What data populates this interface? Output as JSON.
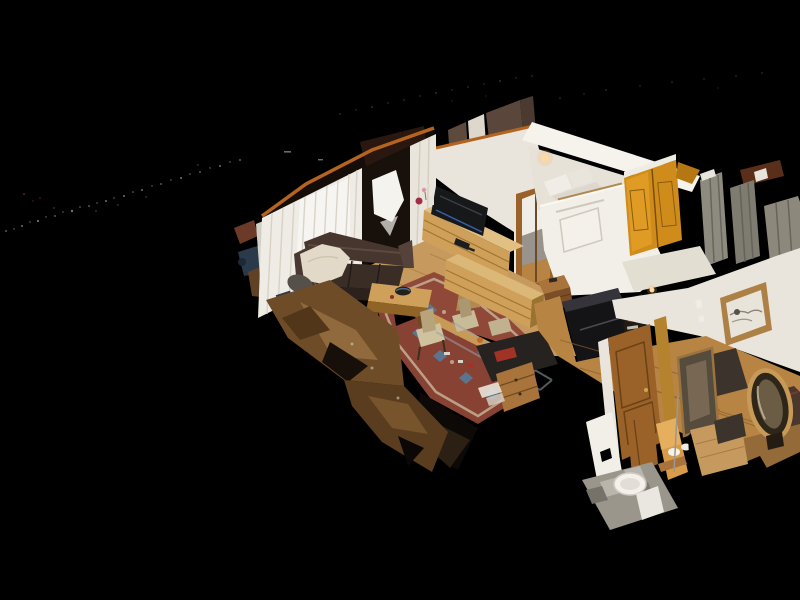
{
  "app": {
    "name": "3D tour viewer",
    "view_mode": "dollhouse",
    "chrome": "none — full-bleed 3D viewport on black"
  },
  "scene": {
    "description": "Cut-away dollhouse view of a chalet apartment photogrammetry scan, seen from an elevated three-quarter angle on a black void with point-cloud noise speckles and torn scan geometry at the edges.",
    "rooms": [
      {
        "name": "living-room",
        "objects": [
          "dark-brown-sofa",
          "sheepskin-throw",
          "oak-coffee-table",
          "decorative-bowl",
          "oriental-rug",
          "flat-screen-tv",
          "oak-sideboard",
          "dining-chairs",
          "glass-dining-table",
          "cardboard-box",
          "dark-desk",
          "red-folder",
          "oak-drawer-cabinet",
          "sheer-white-curtains",
          "balcony-door-gap",
          "roof-beam"
        ]
      },
      {
        "name": "bedroom",
        "objects": [
          "bed-with-white-pillows",
          "grey-blanket",
          "wall-sconces",
          "golden-wardrobe",
          "brown-window-curtains",
          "mirrored-doorway",
          "white-radiator-panel"
        ]
      },
      {
        "name": "hallway",
        "objects": [
          "framed-sketch-picture",
          "dark-fireplace",
          "open-wooden-door",
          "tall-wall-mirror",
          "oval-wood-mirror",
          "dark-doormats",
          "oak-plank-floor",
          "staircase-steps",
          "small-wood-chest"
        ]
      },
      {
        "name": "bathroom-wc",
        "objects": [
          "white-toilet",
          "washbasin",
          "glowing-vanity-wall",
          "grey-tiled-floor",
          "wood-panel-door",
          "glass-shower-panels"
        ]
      }
    ],
    "artifacts": [
      "point-cloud-noise-streaks",
      "broken-scan-geometry-trail",
      "overexposed-window-blob"
    ]
  },
  "palette": {
    "background": "#000000",
    "speckle": "#9fb2b8",
    "speckle_red": "#7a2a1a",
    "beam_orange": "#b4641f",
    "roof_dark": "#150d07",
    "roof_chunk": "#2a1810",
    "wall_white": "#e9e5dd",
    "wall_bright": "#f2efe8",
    "ceiling_white": "#f6f3ec",
    "curtain_white": "#efece6",
    "curtain_shadow": "#d4cdc0",
    "curtain_brown": "#5d4a3c",
    "gap_dark": "#17100b",
    "blob_white": "#f5f3ee",
    "sofa_brown": "#46362d",
    "sofa_seat": "#3a2d26",
    "sofa_front": "#2c211c",
    "sofa_arm": "#4a3930",
    "fur_cream": "#e3d9c8",
    "bean_grey": "#56504a",
    "rug_red": "#8e4536",
    "rug_blue": "#5b7590",
    "rug_beige": "#c8b89b",
    "oak_light": "#cfa05a",
    "oak_top": "#e2bf82",
    "oak_mid": "#a9743c",
    "oak_dark": "#7c4e26",
    "wood_floor": "#c69a5e",
    "wood_floor_warm": "#b78443",
    "door_wood": "#9a6228",
    "door_trim_gold": "#b5832e",
    "wardrobe_gold": "#cf8c1a",
    "tv_black": "#17181a",
    "fireplace_dark": "#141417",
    "glass_grey": "#8d8a80",
    "glass_grey2": "#7e7b71",
    "tile_grey": "#9b968c",
    "debris_brown": "#6e4c28",
    "debris_tan": "#96703f",
    "debris_deep": "#5a3d1f",
    "lamp_glow": "#ffd9a0",
    "glow_wall": "#d89b4a",
    "toilet_white": "#f4f1eb",
    "mat_dark": "#3c342c",
    "bed_white": "#f0ede6",
    "bed_grey": "#9a938c",
    "box_cardboard": "#cfa96e",
    "book_red": "#a03226",
    "paper_white": "#e8e4da",
    "blue_item": "#2b3a4a",
    "mirror_dark": "#564c3e",
    "mirror_frame": "#c89a58",
    "picture_frame": "#ad8146"
  }
}
